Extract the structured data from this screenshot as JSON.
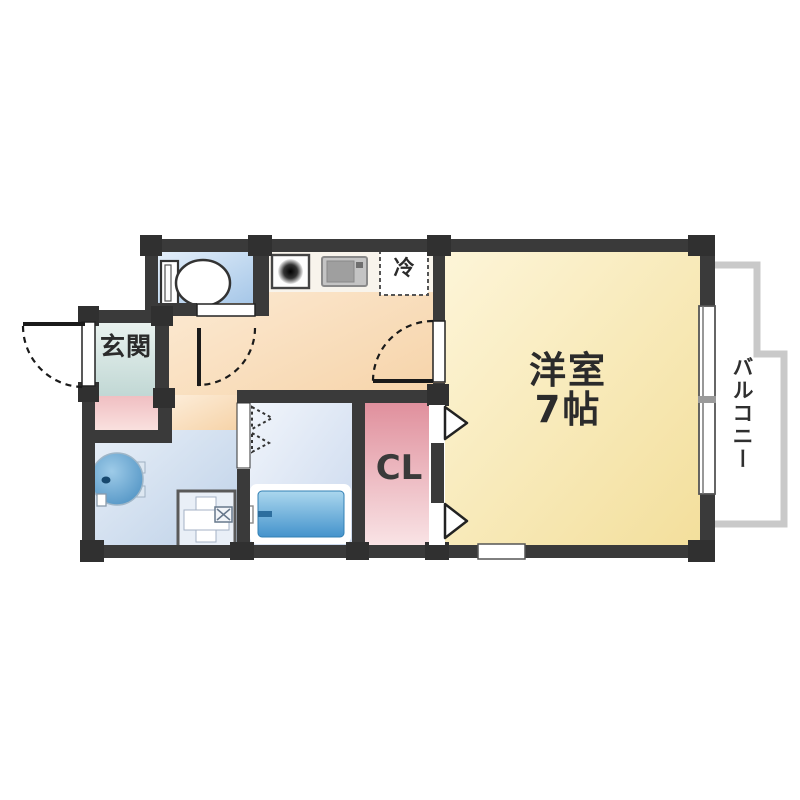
{
  "floor_plan": {
    "entrance": {
      "label": "玄関"
    },
    "main_room": {
      "name": "洋室",
      "size": "7帖"
    },
    "closet": {
      "label": "CL"
    },
    "balcony": {
      "label": "バルコニー"
    },
    "kitchen": {
      "fridge_mark": "冷"
    },
    "colors": {
      "wall": "#3a3a3a",
      "pillar": "#303030",
      "main_room_fill": "#f6e4a8",
      "kitchen_fill": "#f8d9b4",
      "toilet_fill": "#aecbe8",
      "bathroom_fill": "#d6e1f2",
      "washroom_fill": "#c9d8ec",
      "entrance_fill": "#cfdfdc",
      "entrance_step_fill": "#f3c8ca",
      "closet_fill": "#e598a3",
      "bathtub_fill": "#5ba5d6",
      "balcony_rail": "#c9c9c9"
    }
  }
}
